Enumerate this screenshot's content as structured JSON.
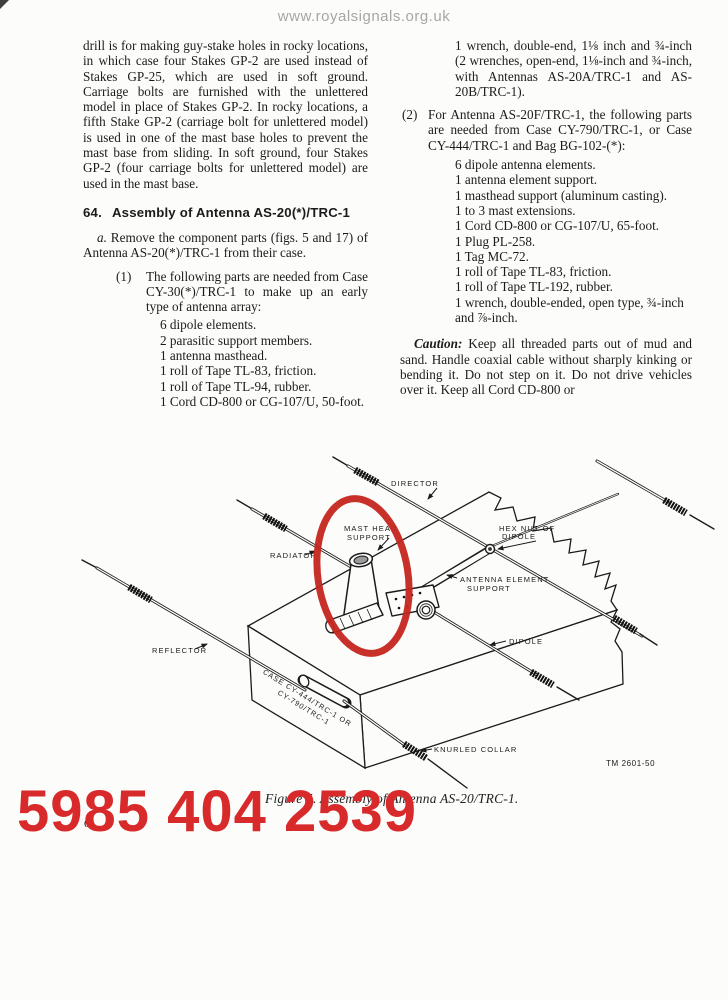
{
  "watermark": "www.royalsignals.org.uk",
  "columns": {
    "left": {
      "para1": "drill is for making guy-stake holes in rocky locations, in which case four Stakes GP-2 are used instead of Stakes GP-25, which are used in soft ground. Carriage bolts are furnished with the unlettered model in place of Stakes GP-2. In rocky locations, a fifth Stake GP-2 (carriage bolt for unlettered model) is used in one of the mast base holes to prevent the mast base from sliding. In soft ground, four Stakes GP-2 (four carriage bolts for unlettered model) are used in the mast base.",
      "heading_num": "64.",
      "heading_text": "Assembly of Antenna AS-20(*)/TRC-1",
      "para_a_label": "a.",
      "para_a": "Remove the component parts (figs. 5 and 17) of Antenna AS-20(*)/TRC-1 from their case.",
      "item1_label": "(1)",
      "item1_intro": "The following parts are needed from Case CY-30(*)/TRC-1 to make up an early type of antenna array:",
      "item1_parts": [
        "6 dipole elements.",
        "2 parasitic support members.",
        "1 antenna masthead.",
        "1 roll of Tape TL-83, friction.",
        "1 roll of Tape TL-94, rubber.",
        "1 Cord CD-800 or CG-107/U, 50-foot."
      ]
    },
    "right": {
      "wrench_item": "1 wrench, double-end, 1⅛ inch and ¾-inch (2 wrenches, open-end, 1⅛-inch and ¾-inch, with Antennas AS-20A/TRC-1 and AS-20B/TRC-1).",
      "item2_label": "(2)",
      "item2_intro": "For Antenna AS-20F/TRC-1, the following parts are needed from Case CY-790/TRC-1, or Case CY-444/TRC-1 and Bag BG-102-(*):",
      "item2_parts": [
        "6 dipole antenna elements.",
        "1 antenna element support.",
        "1 masthead support (aluminum casting).",
        "1 to 3 mast extensions.",
        "1 Cord CD-800 or CG-107/U, 65-foot.",
        "1 Plug PL-258.",
        "1 Tag MC-72.",
        "1 roll of Tape TL-83, friction.",
        "1 roll of Tape TL-192, rubber.",
        "1 wrench, double-ended, open type, ¾-inch and ⅞-inch."
      ],
      "caution_label": "Caution:",
      "caution_text": "Keep all threaded parts out of mud and sand. Handle coaxial cable without sharply kinking or bending it. Do not step on it. Do not drive vehicles over it. Keep all Cord CD-800 or"
    }
  },
  "figure": {
    "labels": {
      "director": "DIRECTOR",
      "mast_head_support": [
        "MAST HEAD",
        "SUPPORT"
      ],
      "radiator": "RADIATOR",
      "hex_nut_of_dipole": [
        "HEX NUT OF",
        "DIPOLE"
      ],
      "antenna_element_support": [
        "ANTENNA ELEMENT",
        "SUPPORT"
      ],
      "dipole": "DIPOLE",
      "reflector": "REFLECTOR",
      "case_marking": [
        "CASE CY-444/TRC-1 OR",
        "CY-790/TRC-1"
      ],
      "knurled_collar": "KNURLED COLLAR"
    },
    "tm_number": "TM 2601-50",
    "caption": "Figure 5. Assembly of Antenna AS-20/TRC-1."
  },
  "overlay": {
    "stock_number": "5985 404 2539"
  },
  "page_number_fragment": "6",
  "colors": {
    "overlay_red": "#d8292b",
    "annotation_red": "#c5261f",
    "ink": "#1b1b1b",
    "watermark_gray": "#a6a6a6"
  }
}
